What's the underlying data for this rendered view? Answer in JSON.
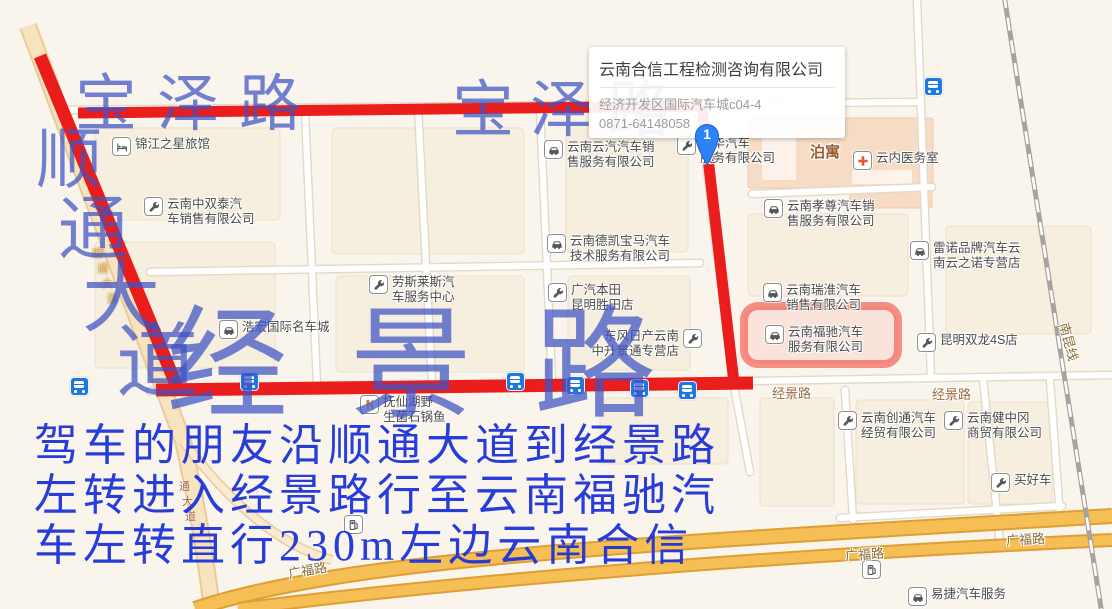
{
  "colors": {
    "overlay_blue": "#3d52c4",
    "directions_blue": "#1c33d8",
    "route_red": "#ea1010",
    "highlight_red": "rgba(238,42,30,0.5)",
    "road_yellow": "#f6bf55",
    "bus_blue": "#1f78e0",
    "pin_blue": "#2c83f6"
  },
  "info_card": {
    "title": "云南合信工程检测咨询有限公司",
    "address": "经济开发区国际汽车城c04-4",
    "phone": "0871-64148058"
  },
  "marker": {
    "label": "1"
  },
  "overlay": {
    "road_names_large": [
      {
        "text": "宝泽路",
        "x": 75,
        "y": 74,
        "size": 62,
        "spacing": 20
      },
      {
        "text": "宝泽路",
        "x": 452,
        "y": 80,
        "size": 62,
        "spacing": 16
      },
      {
        "text": "经景路",
        "x": 166,
        "y": 306,
        "size": 122,
        "spacing": 62
      }
    ],
    "vertical_road_name": [
      {
        "ch": "顺",
        "x": 36,
        "y": 128,
        "size": 66
      },
      {
        "ch": "通",
        "x": 58,
        "y": 196,
        "size": 70
      },
      {
        "ch": "大",
        "x": 82,
        "y": 260,
        "size": 78
      },
      {
        "ch": "道",
        "x": 116,
        "y": 322,
        "size": 82
      }
    ],
    "directions_lines": [
      "驾车的朋友沿顺通大道到经景路",
      "左转进入经景路行至云南福驰汽",
      "车左转直行230m左边云南合信"
    ]
  },
  "road_labels": [
    {
      "text": "经景路",
      "x": 772,
      "y": 383,
      "size": 13,
      "color": "#9b6b41",
      "rot": 0,
      "bold": false
    },
    {
      "text": "经景路",
      "x": 932,
      "y": 384,
      "size": 13,
      "color": "#9b6b41",
      "rot": 0,
      "bold": false
    },
    {
      "text": "广福路",
      "x": 1006,
      "y": 529,
      "size": 13,
      "color": "#8a6a35",
      "rot": -3,
      "bold": false
    },
    {
      "text": "广福路",
      "x": 845,
      "y": 544,
      "size": 13,
      "color": "#8a6a35",
      "rot": -4,
      "bold": false
    },
    {
      "text": "广福路",
      "x": 288,
      "y": 560,
      "size": 13,
      "color": "#8a6a35",
      "rot": -10,
      "bold": false
    },
    {
      "text": "泊寓",
      "x": 810,
      "y": 141,
      "size": 15,
      "color": "#995c31",
      "rot": 0,
      "bold": true
    },
    {
      "text": "南昆线",
      "x": 1050,
      "y": 332,
      "size": 13,
      "color": "#8a6a35",
      "rot": 75,
      "bold": false
    }
  ],
  "on_road_chars": [
    {
      "ch": "顺",
      "x": 92,
      "y": 245,
      "size": 11,
      "color": "#ffd37a",
      "halo": "#7a4a00"
    },
    {
      "ch": "通",
      "x": 97,
      "y": 260,
      "size": 11,
      "color": "#ffd37a",
      "halo": "#7a4a00"
    },
    {
      "ch": "大",
      "x": 102,
      "y": 275,
      "size": 11,
      "color": "#ffd37a",
      "halo": "#7a4a00"
    },
    {
      "ch": "道",
      "x": 107,
      "y": 290,
      "size": 11,
      "color": "#ffd37a",
      "halo": "#7a4a00"
    },
    {
      "ch": "通",
      "x": 179,
      "y": 478,
      "size": 11,
      "color": "#9c6a4a",
      "halo": "#ffffff"
    },
    {
      "ch": "大",
      "x": 182,
      "y": 493,
      "size": 11,
      "color": "#9c6a4a",
      "halo": "#ffffff"
    },
    {
      "ch": "道",
      "x": 185,
      "y": 508,
      "size": 11,
      "color": "#9c6a4a",
      "halo": "#ffffff"
    }
  ],
  "pois": [
    {
      "icon": "hotel-icon",
      "x": 112,
      "y": 137,
      "lines": [
        "锦江之星旅馆"
      ],
      "icon_side": "left"
    },
    {
      "icon": "wrench-icon",
      "x": 144,
      "y": 197,
      "lines": [
        "云南中双泰汽",
        "车销售有限公司"
      ],
      "icon_side": "left"
    },
    {
      "icon": "car-icon",
      "x": 544,
      "y": 140,
      "lines": [
        "云南云汽汽车销",
        "售服务有限公司"
      ],
      "icon_side": "left"
    },
    {
      "icon": "wrench-icon",
      "x": 677,
      "y": 136,
      "lines": [
        "经华汽车",
        "服务有限公司"
      ],
      "icon_side": "left"
    },
    {
      "icon": "cross-icon",
      "x": 853,
      "y": 151,
      "lines": [
        "云内医务室"
      ],
      "icon_side": "left"
    },
    {
      "icon": "car-icon",
      "x": 764,
      "y": 199,
      "lines": [
        "云南孝尊汽车销",
        "售服务有限公司"
      ],
      "icon_side": "left"
    },
    {
      "icon": "car-icon",
      "x": 910,
      "y": 241,
      "lines": [
        "雷诺品牌汽车云",
        "南云之诺专营店"
      ],
      "icon_side": "left"
    },
    {
      "icon": "car-icon",
      "x": 547,
      "y": 234,
      "lines": [
        "云南德凯宝马汽车",
        "技术服务有限公司"
      ],
      "icon_side": "left"
    },
    {
      "icon": "wrench-icon",
      "x": 548,
      "y": 283,
      "lines": [
        "广汽本田",
        "昆明胜田店"
      ],
      "icon_side": "left"
    },
    {
      "icon": "car-icon",
      "x": 763,
      "y": 283,
      "lines": [
        "云南瑞淮汽车",
        "销售有限公司"
      ],
      "icon_side": "left"
    },
    {
      "icon": "wrench-icon",
      "x": 369,
      "y": 275,
      "lines": [
        "劳斯莱斯汽",
        "车服务中心"
      ],
      "icon_side": "left"
    },
    {
      "icon": "car-icon",
      "x": 219,
      "y": 320,
      "lines": [
        "浩宏国际名车城"
      ],
      "icon_side": "left"
    },
    {
      "icon": "wrench-icon",
      "x": 684,
      "y": 329,
      "lines": [
        "东风日产云南",
        "中升景通专营店"
      ],
      "icon_side": "right"
    },
    {
      "icon": "car-icon",
      "x": 765,
      "y": 325,
      "lines": [
        "云南福驰汽车",
        "服务有限公司"
      ],
      "icon_side": "left"
    },
    {
      "icon": "wrench-icon",
      "x": 917,
      "y": 333,
      "lines": [
        "昆明双龙4S店"
      ],
      "icon_side": "left"
    },
    {
      "icon": "wrench-icon",
      "x": 838,
      "y": 411,
      "lines": [
        "云南创通汽车",
        "经贸有限公司"
      ],
      "icon_side": "left"
    },
    {
      "icon": "wrench-icon",
      "x": 944,
      "y": 411,
      "lines": [
        "云南健中冈",
        "商贸有限公司"
      ],
      "icon_side": "left"
    },
    {
      "icon": "restaurant-icon",
      "x": 360,
      "y": 395,
      "lines": [
        "抚仙湖野",
        "生菌石锅鱼"
      ],
      "icon_side": "left"
    },
    {
      "icon": "wrench-icon",
      "x": 991,
      "y": 473,
      "lines": [
        "买好车"
      ],
      "icon_side": "left"
    },
    {
      "icon": "car-icon",
      "x": 908,
      "y": 587,
      "lines": [
        "易捷汽车服务"
      ],
      "icon_side": "left"
    },
    {
      "icon": "gas-icon",
      "x": 344,
      "y": 515,
      "lines": [],
      "icon_side": "left"
    },
    {
      "icon": "gas-icon",
      "x": 862,
      "y": 560,
      "lines": [],
      "icon_side": "left"
    }
  ],
  "bus_stops": [
    {
      "x": 70,
      "y": 377
    },
    {
      "x": 240,
      "y": 372
    },
    {
      "x": 506,
      "y": 372
    },
    {
      "x": 566,
      "y": 376
    },
    {
      "x": 630,
      "y": 379
    },
    {
      "x": 678,
      "y": 381
    },
    {
      "x": 924,
      "y": 77
    }
  ]
}
